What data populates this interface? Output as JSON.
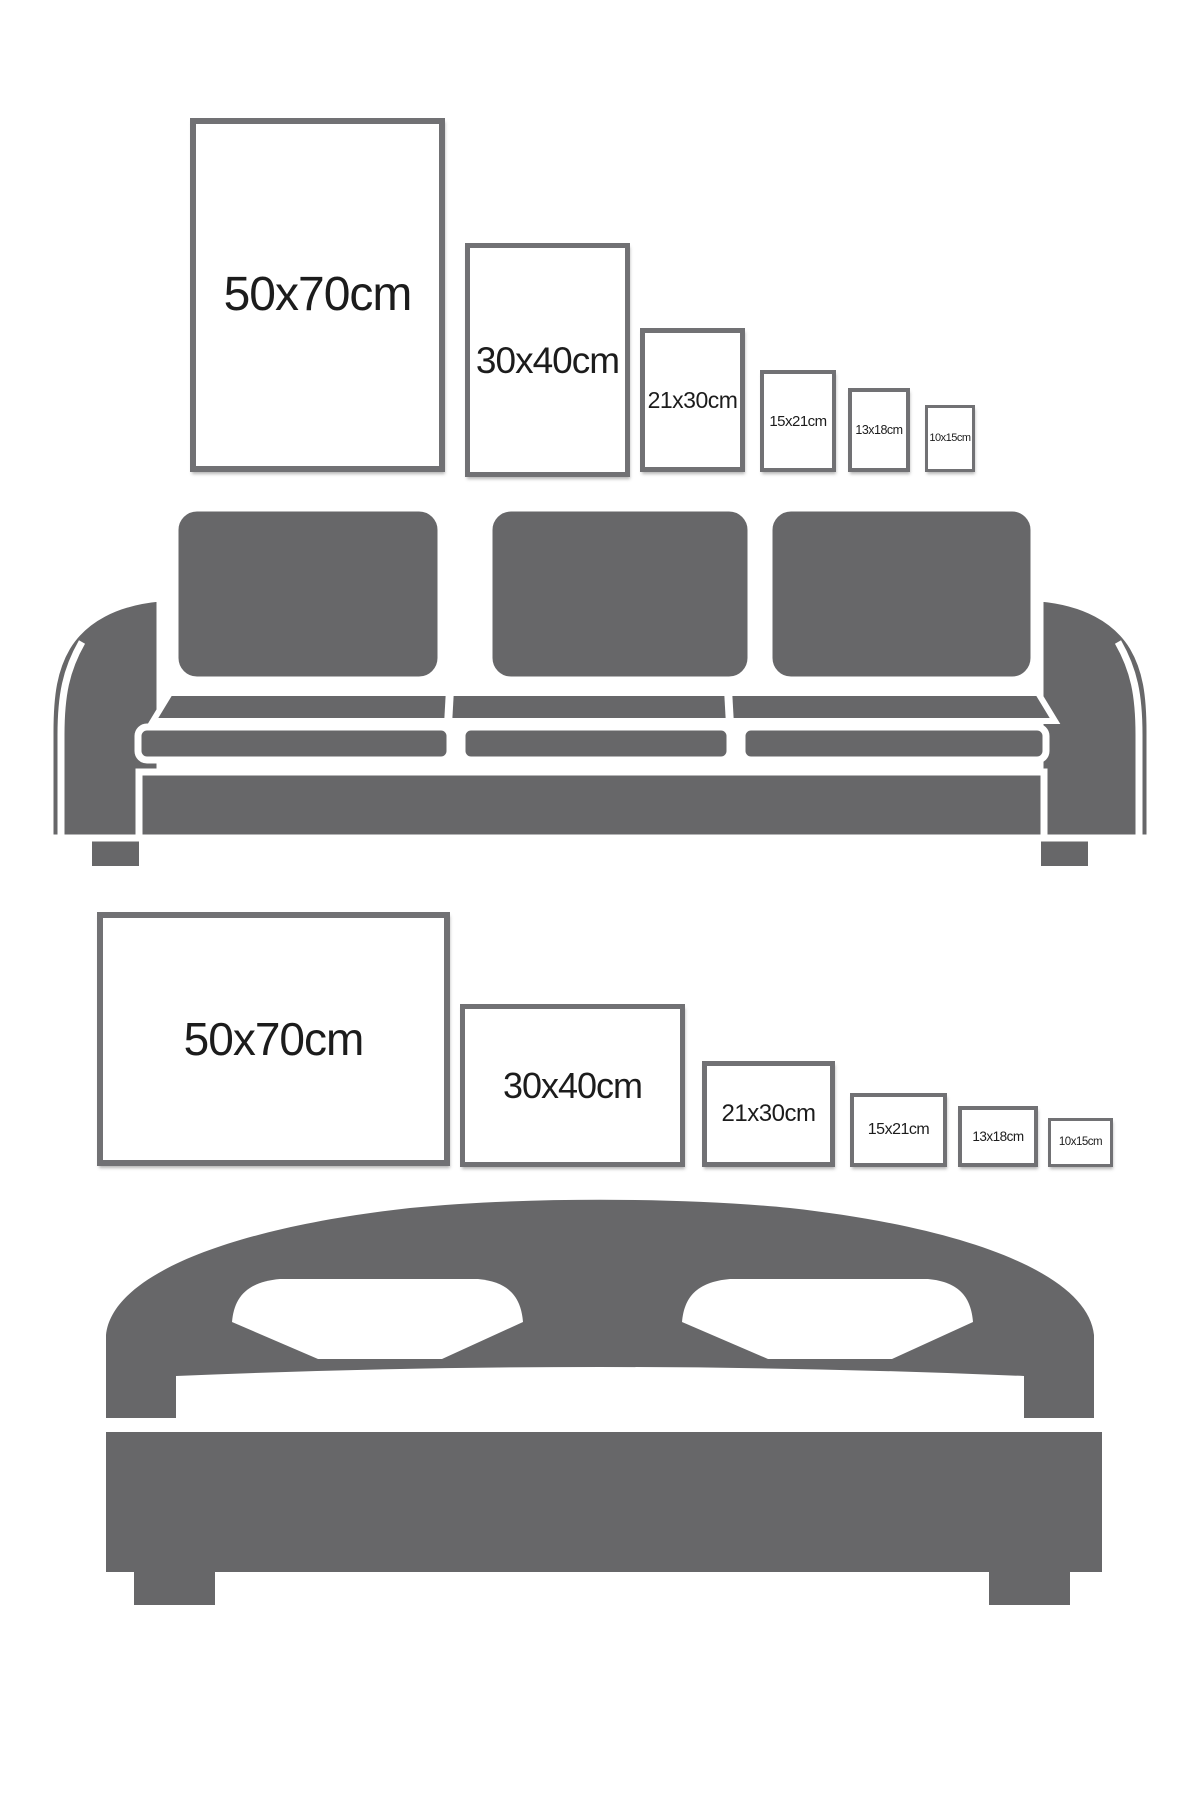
{
  "title": "Poster frame size comparison guide",
  "colors": {
    "furniture_gray": "#676769",
    "frame_border": "#717174",
    "label_text": "#1c1c1c",
    "frame_fill": "#ffffff",
    "background": "#ffffff"
  },
  "top_row": {
    "orientation": "portrait",
    "context": "frames above sofa",
    "frames": [
      {
        "label": "50x70cm"
      },
      {
        "label": "30x40cm"
      },
      {
        "label": "21x30cm"
      },
      {
        "label": "15x21cm"
      },
      {
        "label": "13x18cm"
      },
      {
        "label": "10x15cm"
      }
    ]
  },
  "bottom_row": {
    "orientation": "landscape",
    "context": "frames above bed",
    "frames": [
      {
        "label": "50x70cm"
      },
      {
        "label": "30x40cm"
      },
      {
        "label": "21x30cm"
      },
      {
        "label": "15x21cm"
      },
      {
        "label": "13x18cm"
      },
      {
        "label": "10x15cm"
      }
    ]
  },
  "illustrations": {
    "sofa": "three-seat sofa silhouette",
    "bed": "double bed silhouette with arched headboard and two pillows"
  }
}
